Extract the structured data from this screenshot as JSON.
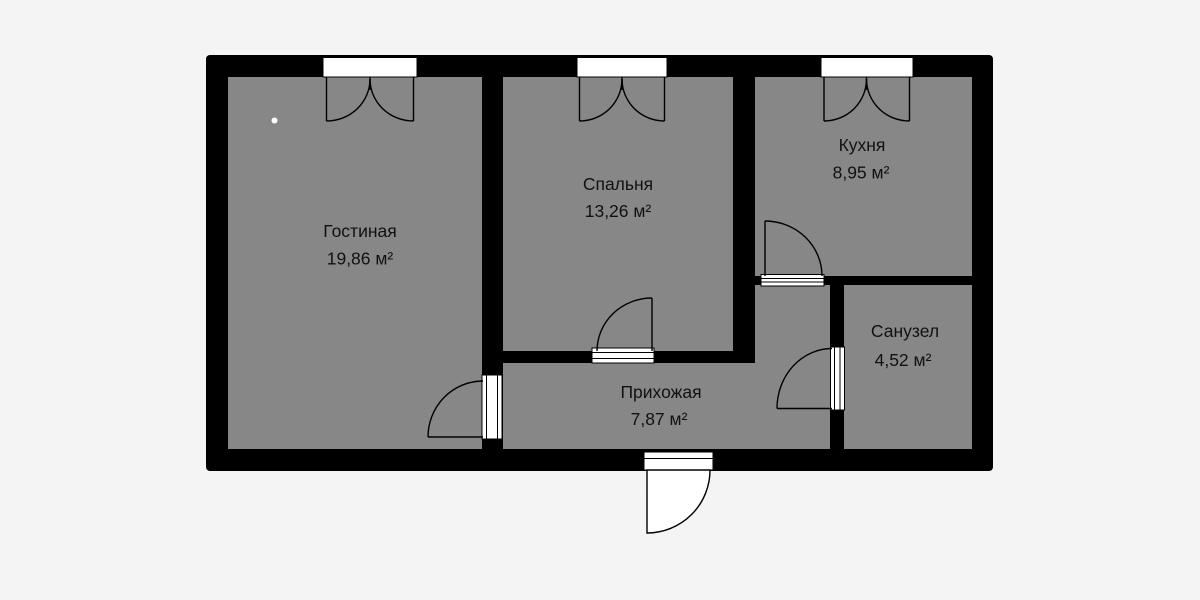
{
  "floor_plan": {
    "type": "apartment-floor-plan",
    "rooms": [
      {
        "id": "living-room",
        "name": "Гостиная",
        "area": "19,86 м²"
      },
      {
        "id": "bedroom",
        "name": "Спальня",
        "area": "13,26 м²"
      },
      {
        "id": "kitchen",
        "name": "Кухня",
        "area": "8,95 м²"
      },
      {
        "id": "bathroom",
        "name": "Санузел",
        "area": "4,52 м²"
      },
      {
        "id": "hallway",
        "name": "Прихожая",
        "area": "7,87 м²"
      }
    ],
    "features": {
      "windows": 3,
      "interior_doors": 4,
      "entrance_doors": 1
    },
    "colors": {
      "background": "#f4f4f4",
      "wall": "#000000",
      "floor": "#878787",
      "opening": "#ffffff",
      "label_text": "#111111"
    }
  }
}
